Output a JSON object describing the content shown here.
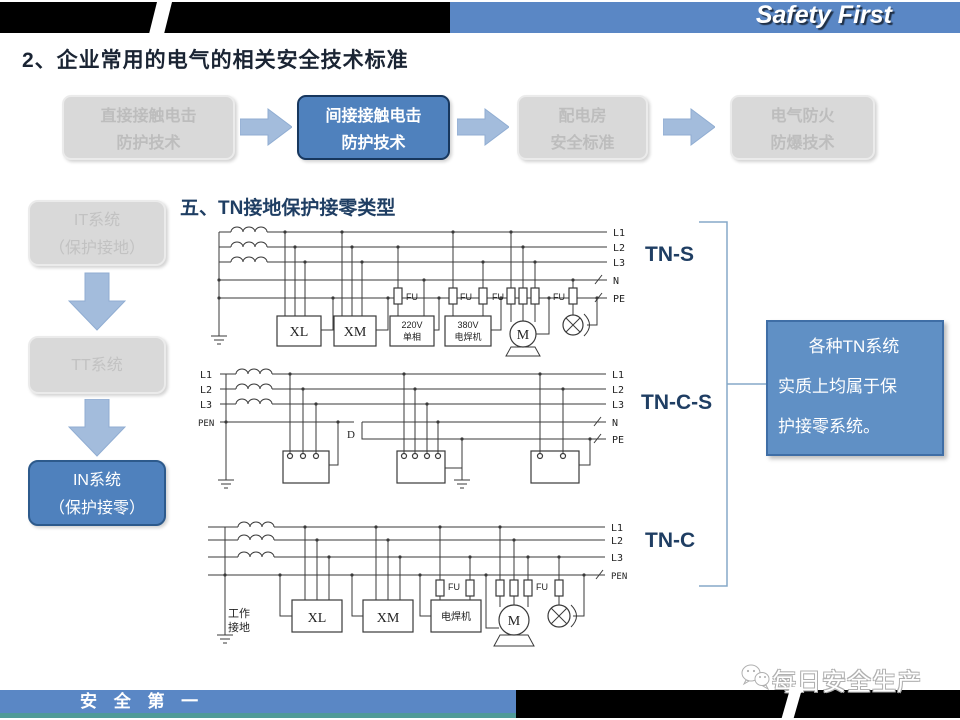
{
  "header": {
    "brand": "Safety First",
    "title": "2、企业常用的电气的相关安全技术标准"
  },
  "flow_boxes": [
    {
      "line1": "直接接触电击",
      "line2": "防护技术"
    },
    {
      "line1": "间接接触电击",
      "line2": "防护技术"
    },
    {
      "line1": "配电房",
      "line2": "安全标准"
    },
    {
      "line1": "电气防火",
      "line2": "防爆技术"
    }
  ],
  "side_boxes": [
    {
      "line1": "IT系统",
      "line2": "（保护接地）"
    },
    {
      "line1": "TT系统",
      "line2": ""
    },
    {
      "line1": "IN系统",
      "line2": "（保护接零）"
    }
  ],
  "section_title": "五、TN接地保护接零类型",
  "diagram_labels": {
    "tn_s": "TN-S",
    "tn_cs": "TN-C-S",
    "tn_c": "TN-C"
  },
  "d1": {
    "bus": {
      "l1": "L1",
      "l2": "L2",
      "l3": "L3",
      "n": "N",
      "pe": "PE"
    },
    "xl": "XL",
    "xm": "XM",
    "v220_1": "220V",
    "v220_2": "单相",
    "v380_1": "380V",
    "v380_2": "电焊机",
    "fu": "FU",
    "m": "M"
  },
  "d2": {
    "left": [
      "L1",
      "L2",
      "L3",
      "PEN"
    ],
    "right": [
      "L1",
      "L2",
      "L3",
      "N",
      "PE"
    ],
    "d": "D"
  },
  "d3": {
    "right": [
      "L1",
      "L2",
      "L3",
      "PEN"
    ],
    "gnd1": "工作",
    "gnd2": "接地",
    "xl": "XL",
    "xm": "XM",
    "welder": "电焊机",
    "fu": "FU",
    "m": "M"
  },
  "note": {
    "lines": [
      "各种TN系统",
      "实质上均属于保",
      "护接零系统。"
    ]
  },
  "footer": {
    "slogan": "安 全 第 一",
    "watermark": "每日安全生产"
  },
  "colors": {
    "header_blue": "#5a87c5",
    "accent_blue": "#4f81bd",
    "arrow_blue": "#a3bcdc",
    "navy": "#1f3e63",
    "note_blue": "#6090c5",
    "teal": "#4f9a98",
    "gray_fill": "#d9d9d9",
    "gray_text": "#bdbdbd",
    "line": "#3a3a3a",
    "dark_border": "#17375e"
  }
}
